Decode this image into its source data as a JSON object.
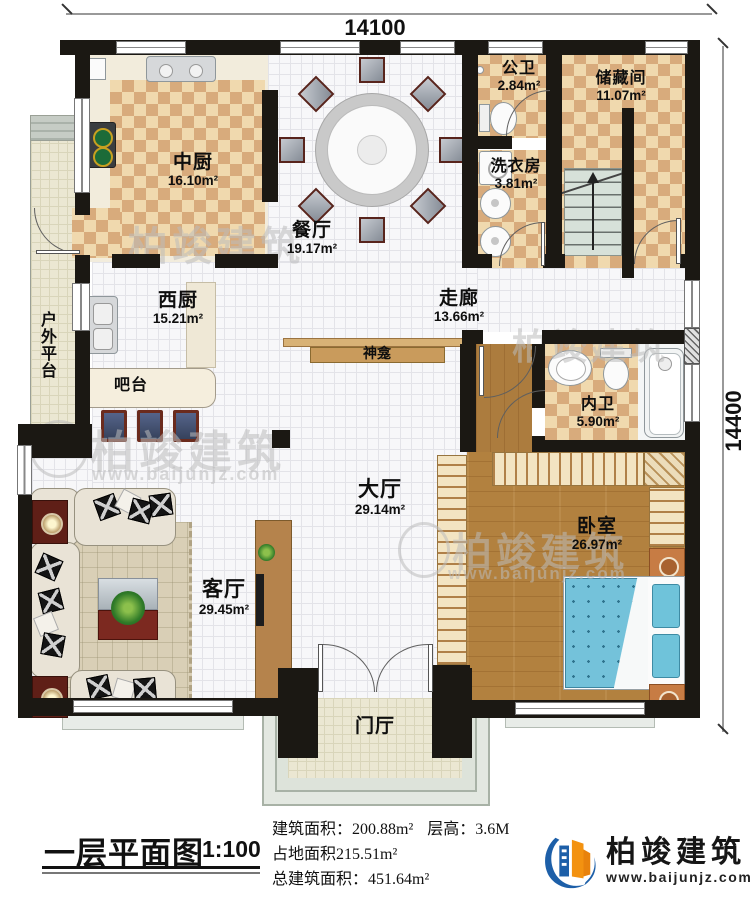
{
  "plan": {
    "dim_top": "14100",
    "dim_right": "14400",
    "rooms": {
      "zhongchu": {
        "name": "中厨",
        "area": "16.10m²"
      },
      "canting": {
        "name": "餐厅",
        "area": "19.17m²"
      },
      "gongwei": {
        "name": "公卫",
        "area": "2.84m²"
      },
      "chucang": {
        "name": "储藏间",
        "area": "11.07m²"
      },
      "xiyifang": {
        "name": "洗衣房",
        "area": "3.81m²"
      },
      "zoulang": {
        "name": "走廊",
        "area": "13.66m²"
      },
      "xichu": {
        "name": "西厨",
        "area": "15.21m²"
      },
      "neiwei": {
        "name": "内卫",
        "area": "5.90m²"
      },
      "dating": {
        "name": "大厅",
        "area": "29.14m²"
      },
      "keting": {
        "name": "客厅",
        "area": "29.45m²"
      },
      "woshi": {
        "name": "卧室",
        "area": "26.97m²"
      },
      "menting": {
        "name": "门厅"
      },
      "pingtai": {
        "name": "户外平台"
      },
      "batai": {
        "name": "吧台"
      },
      "shenkan": {
        "name": "神龛"
      }
    }
  },
  "footer": {
    "title": "一层平面图",
    "scale": "1:100",
    "stats": {
      "building_area": "建筑面积：200.88m²",
      "floor_height": "层高：3.6M",
      "land_area": "占地面积215.51m²",
      "total_area": "总建筑面积：451.64m²"
    },
    "brand": {
      "name": "柏竣建筑",
      "url": "www.baijunjz.com"
    }
  },
  "watermark": {
    "brand": "柏竣建筑",
    "url": "www.baijunjz.com"
  },
  "colors": {
    "wall": "#1b1813",
    "checker_dark": "#d8ab7c",
    "checker_light": "#f0d9ae",
    "wood": "#b2813f",
    "bed": "#74c2da",
    "brand_blue": "#1d5fa8",
    "brand_orange": "#f39210"
  }
}
